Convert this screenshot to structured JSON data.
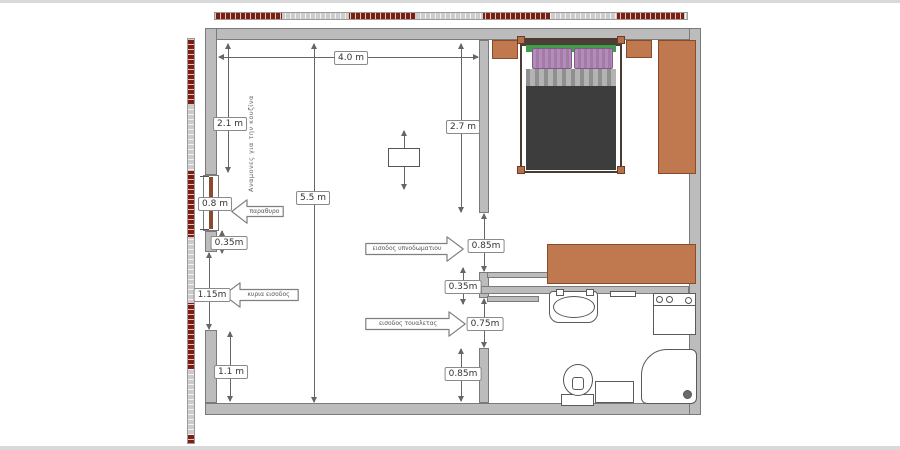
{
  "plan": {
    "type": "apartment-floor-plan",
    "colors": {
      "wall": "#bcbcbc",
      "wall_border": "#7a7a7a",
      "furniture": "#c0784e",
      "furniture_border": "#8a4a2c",
      "scale_red": "#7e1d12",
      "scale_gray": "#cccccc",
      "blanket": "#3d3d3d",
      "pillow": "#b18ab4",
      "headboard_band": "#3f9e4a",
      "window_frame": "#8a4b2c",
      "fixture_border": "#5a5a5a"
    },
    "dimensions": {
      "top_width": "4.0 m",
      "left_upper_wall": "2.1 m",
      "bedroom_wall": "2.7 m",
      "total_height": "5.5 m",
      "window_width": "0.8 m",
      "left_wall_stub": "0.35m",
      "main_entrance_width": "1.15m",
      "left_wall_lower": "1.1 m",
      "bedroom_door_width": "0.85m",
      "mid_wall_stub": "0.35m",
      "toilet_door_width": "0.75m",
      "lower_mid_wall": "0.85m"
    },
    "annotations": {
      "kitchen_note": "Αναμονες για την κουζίνα",
      "window_arrow": "παραθυρο",
      "main_entrance_arrow": "κυρια εισοδος",
      "bedroom_entrance_arrow": "εισοδος υπνοδωματιου",
      "toilet_entrance_arrow": "εισοδος τουαλετας"
    }
  }
}
